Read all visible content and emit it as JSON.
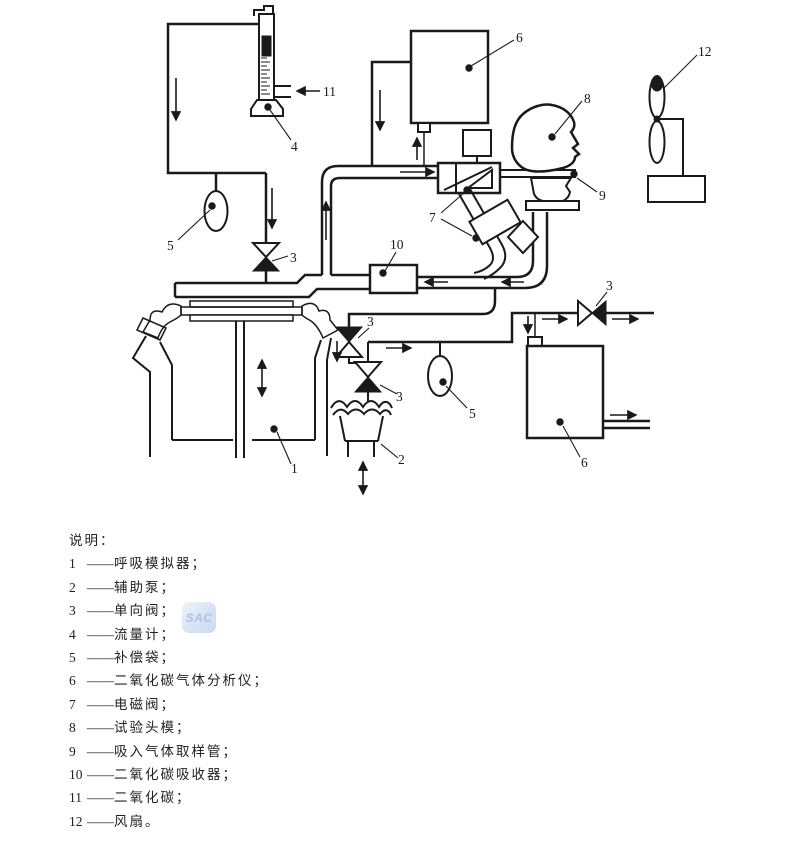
{
  "diagram": {
    "watermark": "SAC",
    "labels": {
      "analyzer_top": "6",
      "head": "8",
      "fan": "12",
      "co2_supply": "11",
      "flowmeter": "4",
      "sampling_tube": "9",
      "solenoid": "7",
      "bag_left": "5",
      "check_left": "3",
      "absorber": "10",
      "check_right": "3",
      "check_pump_upper": "3",
      "check_pump_lower": "3",
      "bag_right": "5",
      "pump": "2",
      "simulator": "1",
      "analyzer_right": "6"
    }
  },
  "legend": {
    "title": "说明：",
    "items": [
      {
        "num": "1",
        "dash": "——",
        "text": "呼吸模拟器；"
      },
      {
        "num": "2",
        "dash": "——",
        "text": "辅助泵；"
      },
      {
        "num": "3",
        "dash": "——",
        "text": "单向阀；"
      },
      {
        "num": "4",
        "dash": "——",
        "text": "流量计；"
      },
      {
        "num": "5",
        "dash": "——",
        "text": "补偿袋；"
      },
      {
        "num": "6",
        "dash": "——",
        "text": "二氧化碳气体分析仪；"
      },
      {
        "num": "7",
        "dash": "——",
        "text": "电磁阀；"
      },
      {
        "num": "8",
        "dash": "——",
        "text": "试验头模；"
      },
      {
        "num": "9",
        "dash": "——",
        "text": "吸入气体取样管；"
      },
      {
        "num": "10",
        "dash": "——",
        "text": "二氧化碳吸收器；"
      },
      {
        "num": "11",
        "dash": "——",
        "text": "二氧化碳；"
      },
      {
        "num": "12",
        "dash": "——",
        "text": "风扇。"
      }
    ]
  }
}
